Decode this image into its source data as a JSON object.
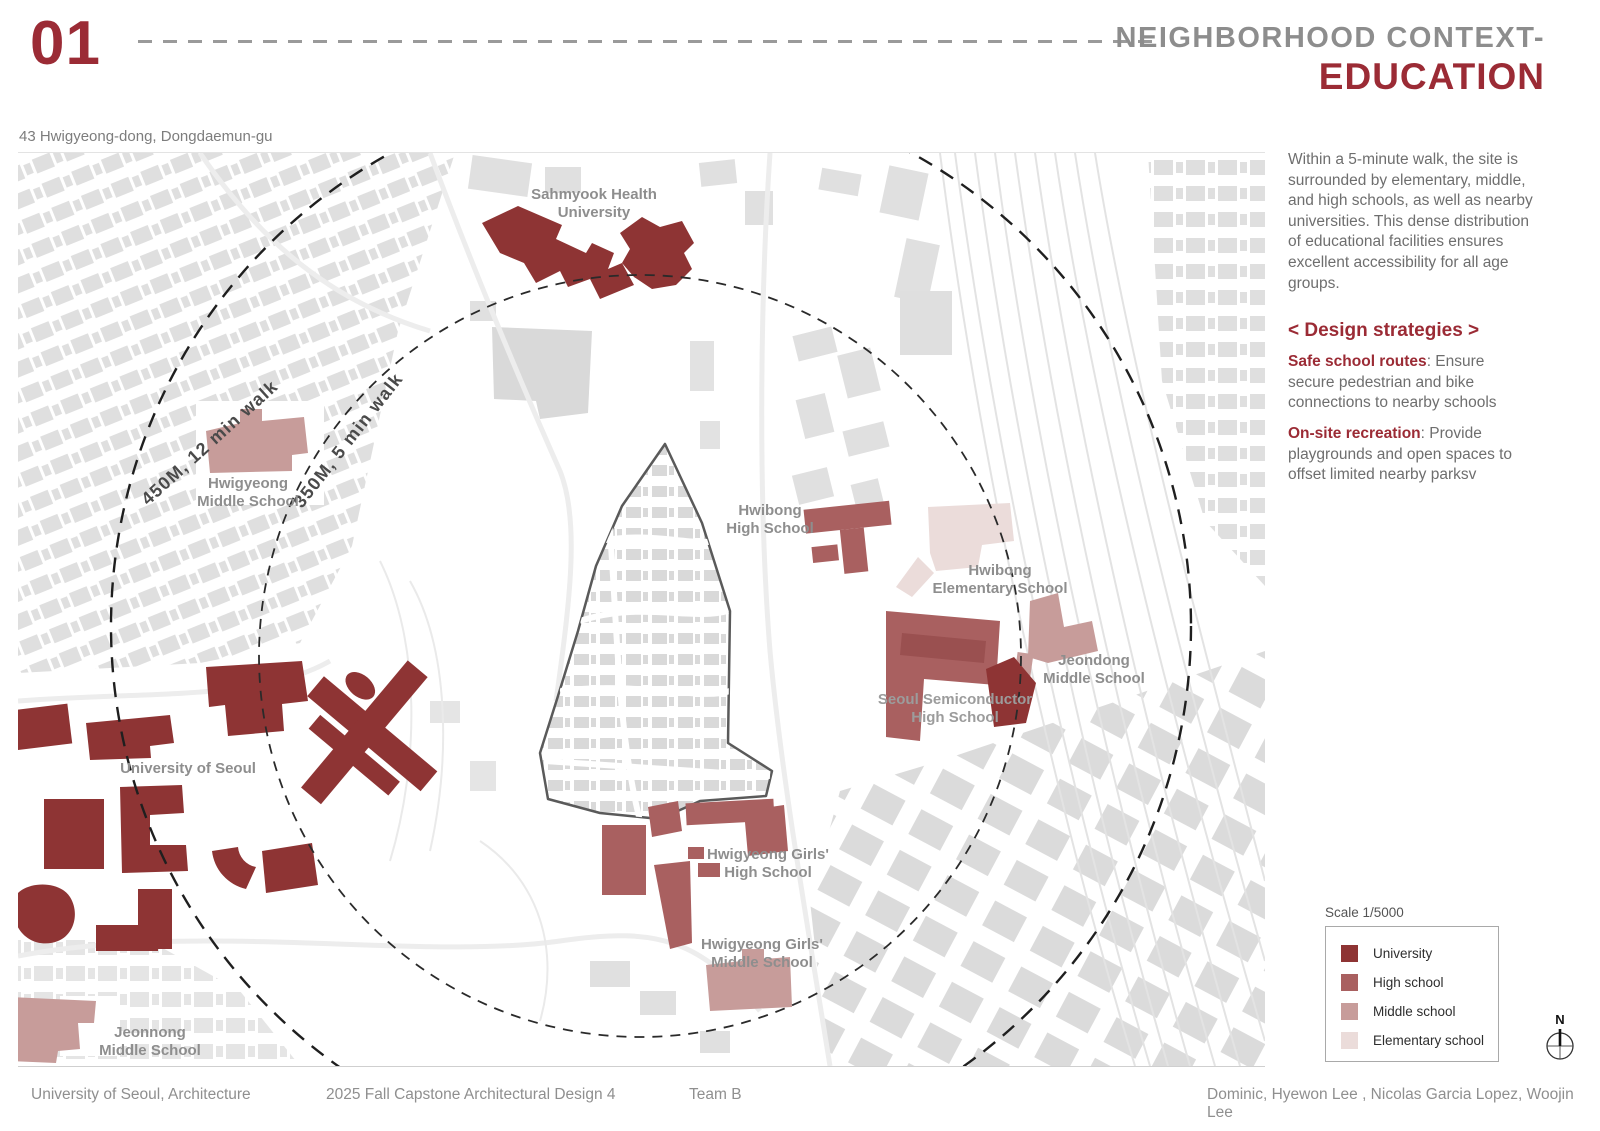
{
  "header": {
    "number": "01",
    "title_line1": "NEIGHBORHOOD CONTEXT-",
    "title_line2": "EDUCATION",
    "address": "43 Hwigyeong-dong, Dongdaemun-gu"
  },
  "colors": {
    "accent": "#9B2B35",
    "university": "#8E3434",
    "high_school": "#A96060",
    "middle_school": "#C79C9A",
    "elementary_school": "#EBDCDA"
  },
  "map": {
    "radius_labels": [
      "450M, 12 min walk",
      "350M, 5 min walk"
    ],
    "schools": {
      "sahmyook": {
        "line1": "Sahmyook Health",
        "line2": "University"
      },
      "hwigyeong_middle": {
        "line1": "Hwigyeong",
        "line2": "Middle School"
      },
      "hwibong_high": {
        "line1": "Hwibong",
        "line2": "High School"
      },
      "hwibong_elementary": {
        "line1": "Hwibong",
        "line2": "Elementary School"
      },
      "jeondong_middle": {
        "line1": "Jeondong",
        "line2": "Middle School"
      },
      "seoul_semiconductor_high": {
        "line1": "Seoul Semiconductor",
        "line2": "High School"
      },
      "university_of_seoul": {
        "line1": "University of Seoul"
      },
      "hwigyeong_girls_high": {
        "line1": "Hwigyeong Girls'",
        "line2": "High School"
      },
      "hwigyeong_girls_middle": {
        "line1": "Hwigyeong Girls'",
        "line2": "Middle School"
      },
      "jeonnong_middle": {
        "line1": "Jeonnong",
        "line2": "Middle School"
      }
    }
  },
  "sidebar": {
    "paragraph": "Within a 5-minute walk, the site is surrounded by elementary, middle, and high schools, as well as nearby universities. This dense distribution of educational facilities ensures excellent accessibility for all age groups.",
    "strategies_title": "< Design strategies >",
    "strategies": [
      {
        "term": "Safe school routes",
        "desc": ": Ensure secure pedestrian and bike connections to nearby schools"
      },
      {
        "term": "On-site recreation",
        "desc": ": Provide playgrounds and open spaces to offset limited nearby parksv"
      }
    ]
  },
  "legend": {
    "scale": "Scale 1/5000",
    "items": [
      {
        "label": "University"
      },
      {
        "label": "High school"
      },
      {
        "label": "Middle school"
      },
      {
        "label": "Elementary school"
      }
    ],
    "compass": "N"
  },
  "footer": {
    "left": "University of Seoul, Architecture",
    "center": "2025 Fall Capstone Architectural Design 4",
    "team": "Team B",
    "right": "Dominic, Hyewon Lee , Nicolas Garcia Lopez, Woojin Lee"
  }
}
